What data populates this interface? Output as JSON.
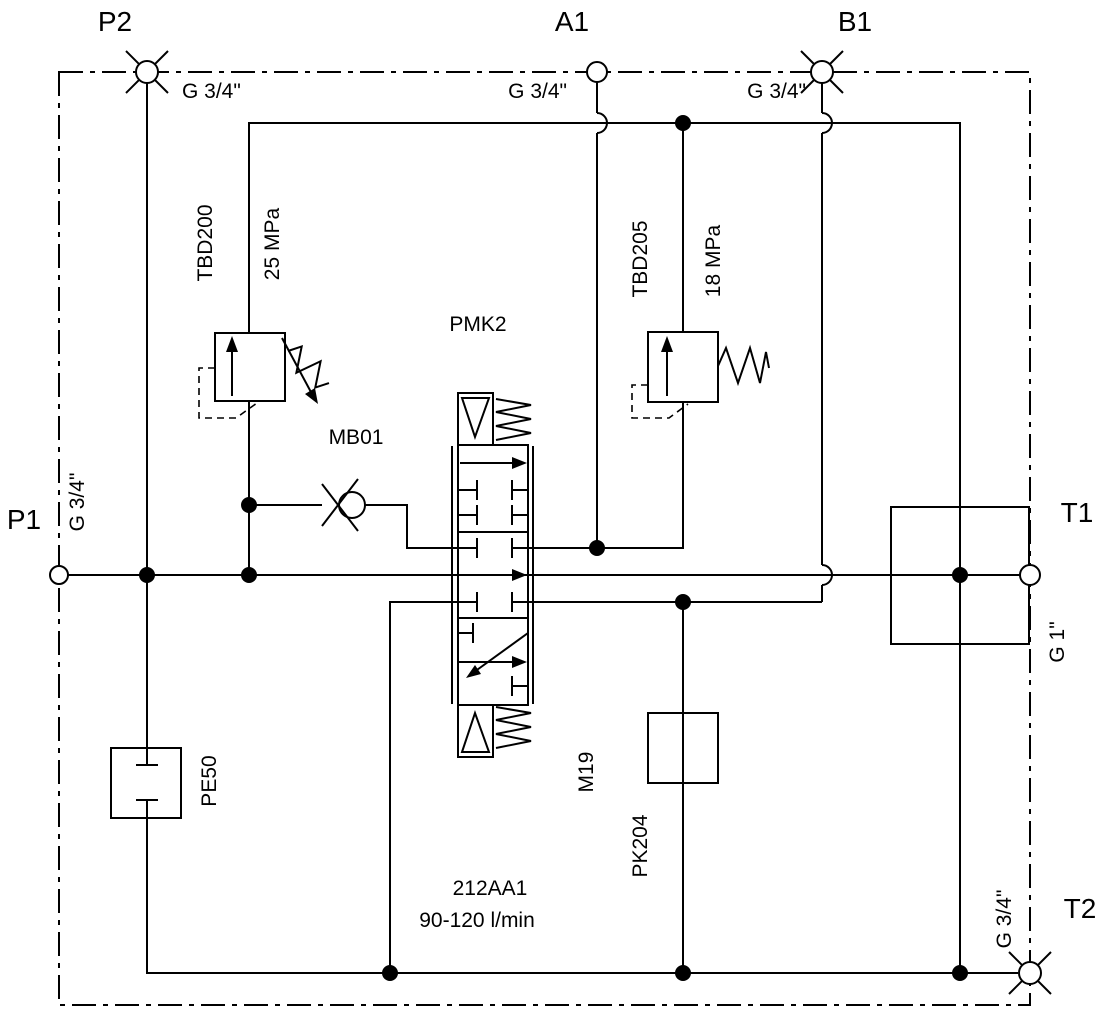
{
  "schematic": {
    "ports": {
      "p2": {
        "name": "P2",
        "thread": "G 3/4\""
      },
      "a1": {
        "name": "A1",
        "thread": "G 3/4\""
      },
      "b1": {
        "name": "B1",
        "thread": "G 3/4\""
      },
      "p1": {
        "name": "P1",
        "thread": "G 3/4\""
      },
      "t1": {
        "name": "T1",
        "thread": "G 1\""
      },
      "t2": {
        "name": "T2",
        "thread": "G 3/4\""
      }
    },
    "components": {
      "relief_main": {
        "id": "TBD200",
        "setting": "25 MPa"
      },
      "relief_port": {
        "id": "TBD205",
        "setting": "18 MPa"
      },
      "directional": {
        "id": "PMK2"
      },
      "check": {
        "id": "MB01"
      },
      "plug_pe50": {
        "id": "PE50"
      },
      "test_point": {
        "id": "M19"
      },
      "plug_pk204": {
        "id": "PK204"
      }
    },
    "notes": {
      "model": "212AA1",
      "flow": "90-120 l/min"
    },
    "colors": {
      "line": "#000000",
      "text": "#000000",
      "background": "#ffffff"
    }
  }
}
